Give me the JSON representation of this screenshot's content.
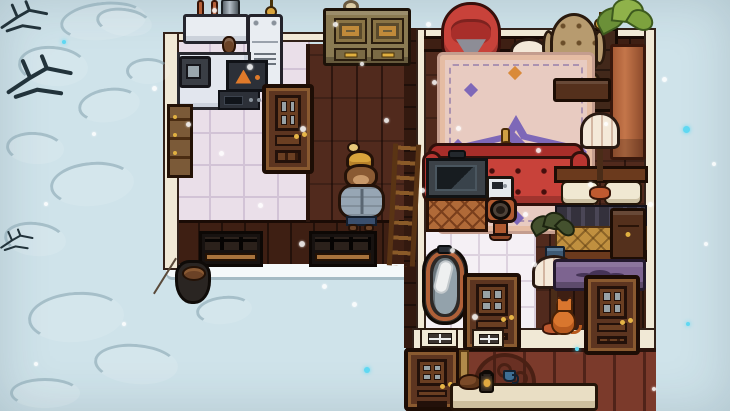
{
  "scene": {
    "description": "Top-down cozy game scene: snowy exterior around a cabin interior with kitchen, living room, bathroom and bedroom; a bear character in a beanie and puffer jacket stands in the living room while snow falls.",
    "palette": {
      "snow_ground": "#cfe3ea",
      "drift_outline": "#809eac",
      "twig": "#22333b",
      "wall_cream": "#f1e9d6",
      "wall_dark_wood": "#3e1f13",
      "wall_exterior_red": "#7b3a2b",
      "floor_planks": "#512a1d",
      "kitchen_tile": "#eadfe9",
      "bathroom_tile": "#f5f0f5",
      "rug_pink": "#e8cbc1",
      "rug_purple": "#7e68b8",
      "rug_orange": "#d98a3a",
      "sofa_red": "#c8423a",
      "chair_tan": "#b79b6f",
      "wood_furniture": "#6b3a1d",
      "olive_cabinet": "#8a7a52",
      "copper": "#b06038",
      "appliance_white": "#e9edf2",
      "metal_slate": "#93a2ab",
      "chest_purple": "#7d6490",
      "lamp_cream": "#f4e9d9",
      "plant_green": "#7da23e",
      "terracotta": "#c4764a",
      "bear_fur": "#8a5a33",
      "bear_hat_gold": "#d9a43c",
      "bear_jacket": "#97a6b4",
      "bear_pants": "#3a4f6e",
      "snowflake_white": "#ffffff",
      "snowflake_cyan": "#5fd8f2"
    },
    "regions": [
      {
        "name": "kitchen-floor",
        "kind": "floor-tiles-lav",
        "x": 177,
        "y": 38,
        "w": 133,
        "h": 190,
        "i": false
      },
      {
        "name": "living-room-floor",
        "kind": "floor-planks",
        "x": 308,
        "y": 44,
        "w": 104,
        "h": 182,
        "i": false
      },
      {
        "name": "bedroom-floor",
        "kind": "floor-planks",
        "x": 426,
        "y": 44,
        "w": 220,
        "h": 288,
        "i": false
      },
      {
        "name": "bathroom-floor",
        "kind": "floor-tiles-white",
        "x": 424,
        "y": 186,
        "w": 112,
        "h": 146,
        "i": false
      },
      {
        "name": "living-room-south-wall",
        "kind": "wall-face-dark",
        "x": 177,
        "y": 220,
        "w": 235,
        "h": 48,
        "i": false
      },
      {
        "name": "snow-ledge",
        "kind": "snow-band",
        "x": 166,
        "y": 264,
        "w": 258,
        "h": 13,
        "i": false
      },
      {
        "name": "divider-wall",
        "kind": "seam-wall",
        "x": 404,
        "y": 28,
        "w": 14,
        "h": 320,
        "i": false
      },
      {
        "name": "divider-wall-edge",
        "kind": "wall-strip-cream",
        "x": 416,
        "y": 28,
        "w": 10,
        "h": 320,
        "i": false
      },
      {
        "name": "bedroom-north-edge",
        "kind": "wall-band-cream",
        "x": 424,
        "y": 28,
        "w": 222,
        "h": 10,
        "i": false
      },
      {
        "name": "bedroom-north-wall",
        "kind": "wall-face-dark",
        "x": 424,
        "y": 36,
        "w": 222,
        "h": 16,
        "i": false
      },
      {
        "name": "kitchen-north-edge",
        "kind": "wall-band-cream",
        "x": 177,
        "y": 32,
        "w": 231,
        "h": 10,
        "i": false
      },
      {
        "name": "left-wall-edge",
        "kind": "wall-strip-cream",
        "x": 163,
        "y": 32,
        "w": 16,
        "h": 238,
        "i": false
      },
      {
        "name": "right-wall-edge",
        "kind": "wall-strip-cream",
        "x": 644,
        "y": 28,
        "w": 12,
        "h": 324,
        "i": false
      },
      {
        "name": "bedroom-under-bed-wall",
        "kind": "wall-face-dark",
        "x": 552,
        "y": 284,
        "w": 94,
        "h": 52,
        "i": false
      },
      {
        "name": "south-wall-top-band",
        "kind": "wall-band-cream",
        "x": 412,
        "y": 328,
        "w": 244,
        "h": 22,
        "i": false
      },
      {
        "name": "south-wall-exterior-face",
        "kind": "wall-face-red",
        "x": 406,
        "y": 348,
        "w": 250,
        "h": 63,
        "i": false
      },
      {
        "name": "kitchen-living-seam",
        "kind": "seam",
        "x": 306,
        "y": 44,
        "w": 4,
        "h": 178,
        "i": false
      }
    ],
    "drifts": [
      {
        "name": "snow-drift",
        "kind": "drift",
        "x": 60,
        "y": 2,
        "w": 86,
        "h": 38,
        "r": -6,
        "i": false
      },
      {
        "name": "snow-drift",
        "kind": "drift",
        "x": 18,
        "y": 46,
        "w": 70,
        "h": 40,
        "r": 5,
        "i": false
      },
      {
        "name": "snow-drift",
        "kind": "drift",
        "x": 78,
        "y": 88,
        "w": 62,
        "h": 34,
        "r": -8,
        "i": false
      },
      {
        "name": "snow-drift",
        "kind": "drift",
        "x": 6,
        "y": 132,
        "w": 58,
        "h": 32,
        "r": 4,
        "i": false
      },
      {
        "name": "snow-drift",
        "kind": "drift",
        "x": 50,
        "y": 162,
        "w": 84,
        "h": 44,
        "r": -5,
        "i": false
      },
      {
        "name": "snow-drift",
        "kind": "drift",
        "x": 4,
        "y": 222,
        "w": 62,
        "h": 34,
        "r": 6,
        "i": false
      },
      {
        "name": "snow-drift",
        "kind": "drift",
        "x": 28,
        "y": 292,
        "w": 96,
        "h": 50,
        "r": -4,
        "i": false
      },
      {
        "name": "snow-drift",
        "kind": "drift",
        "x": 94,
        "y": 344,
        "w": 84,
        "h": 40,
        "r": 5,
        "i": false
      },
      {
        "name": "snow-drift",
        "kind": "drift",
        "x": 126,
        "y": 58,
        "w": 44,
        "h": 26,
        "r": 0,
        "i": false
      },
      {
        "name": "snow-drift",
        "kind": "drift",
        "x": 96,
        "y": 8,
        "w": 56,
        "h": 28,
        "r": 8,
        "i": false
      },
      {
        "name": "snow-drift",
        "kind": "drift",
        "x": 196,
        "y": 296,
        "w": 56,
        "h": 28,
        "r": -6,
        "i": false
      },
      {
        "name": "snow-drift",
        "kind": "drift",
        "x": 10,
        "y": 378,
        "w": 70,
        "h": 30,
        "r": 0,
        "i": false
      }
    ],
    "twigs": [
      {
        "name": "bare-branch",
        "kind": "twig",
        "x": 0,
        "y": 0,
        "w": 52,
        "h": 36,
        "i": false
      },
      {
        "name": "bare-branch",
        "kind": "twig",
        "x": 6,
        "y": 54,
        "w": 72,
        "h": 50,
        "i": false
      },
      {
        "name": "bare-branch",
        "kind": "twig",
        "x": 0,
        "y": 226,
        "w": 36,
        "h": 30,
        "i": false
      }
    ],
    "items": [
      {
        "name": "wall-knob-light",
        "kind": "knob-bulb",
        "x": 343,
        "y": 0,
        "w": 16,
        "h": 13,
        "i": true
      },
      {
        "name": "kitchen-wall-lamp",
        "kind": "wall-lamp",
        "x": 263,
        "y": 0,
        "w": 18,
        "h": 18,
        "i": true
      },
      {
        "name": "stove",
        "kind": "stove",
        "x": 183,
        "y": 0,
        "w": 66,
        "h": 56,
        "i": true
      },
      {
        "name": "fridge",
        "kind": "fridge",
        "x": 247,
        "y": 14,
        "w": 36,
        "h": 76,
        "i": true
      },
      {
        "name": "armoire-cabinet",
        "kind": "armoire",
        "x": 323,
        "y": 8,
        "w": 88,
        "h": 58,
        "i": true
      },
      {
        "name": "kitchen-counter",
        "kind": "counter",
        "x": 177,
        "y": 52,
        "w": 74,
        "h": 58,
        "i": true
      },
      {
        "name": "microwave-large",
        "kind": "micro-dark",
        "x": 179,
        "y": 56,
        "w": 32,
        "h": 32,
        "i": true
      },
      {
        "name": "oven-warning-panel",
        "kind": "oven-warning",
        "x": 226,
        "y": 60,
        "w": 42,
        "h": 32,
        "i": true
      },
      {
        "name": "microwave-small",
        "kind": "micro-small",
        "x": 218,
        "y": 90,
        "w": 42,
        "h": 20,
        "i": true
      },
      {
        "name": "tall-cabinet",
        "kind": "cabinet-tall",
        "x": 167,
        "y": 104,
        "w": 26,
        "h": 74,
        "i": true
      },
      {
        "name": "kitchen-door",
        "kind": "door",
        "x": 262,
        "y": 84,
        "w": 52,
        "h": 90,
        "i": true
      },
      {
        "name": "red-armchair",
        "kind": "armchair-red",
        "x": 441,
        "y": 2,
        "w": 60,
        "h": 62,
        "i": true
      },
      {
        "name": "dark-cabinet",
        "kind": "cabinet-dark",
        "x": 584,
        "y": 28,
        "w": 34,
        "h": 84,
        "i": true
      },
      {
        "name": "bedroom-wall-lamp",
        "kind": "wall-lamp",
        "x": 592,
        "y": 12,
        "w": 20,
        "h": 30,
        "i": true
      },
      {
        "name": "side-table-lamp",
        "kind": "lamp-table",
        "x": 503,
        "y": 38,
        "w": 52,
        "h": 68,
        "i": true
      },
      {
        "name": "wingback-chair",
        "kind": "wingback",
        "x": 544,
        "y": 13,
        "w": 60,
        "h": 84,
        "i": true
      },
      {
        "name": "tall-planter",
        "kind": "planter",
        "x": 598,
        "y": 0,
        "w": 54,
        "h": 162,
        "i": true
      },
      {
        "name": "area-rug",
        "kind": "rug",
        "x": 437,
        "y": 52,
        "w": 158,
        "h": 182,
        "i": true
      },
      {
        "name": "dark-side-table",
        "kind": "dark-table",
        "x": 553,
        "y": 78,
        "w": 58,
        "h": 24,
        "i": true
      },
      {
        "name": "gold-vase",
        "kind": "gold-vase",
        "x": 494,
        "y": 128,
        "w": 24,
        "h": 48,
        "i": true
      },
      {
        "name": "red-couch",
        "kind": "couch",
        "x": 422,
        "y": 143,
        "w": 168,
        "h": 66,
        "i": true
      },
      {
        "name": "bed",
        "kind": "bed",
        "x": 554,
        "y": 166,
        "w": 94,
        "h": 98,
        "i": true
      },
      {
        "name": "bedroom-floor-lamp",
        "kind": "lamp",
        "x": 580,
        "y": 112,
        "w": 40,
        "h": 88,
        "i": true
      },
      {
        "name": "nightstand",
        "kind": "nightstand",
        "x": 610,
        "y": 208,
        "w": 36,
        "h": 52,
        "i": true
      },
      {
        "name": "sink-vanity",
        "kind": "sink-vanity",
        "x": 426,
        "y": 152,
        "w": 62,
        "h": 80,
        "i": true
      },
      {
        "name": "white-appliance",
        "kind": "appliance",
        "x": 486,
        "y": 176,
        "w": 28,
        "h": 34,
        "i": true
      },
      {
        "name": "toilet",
        "kind": "toilet",
        "x": 485,
        "y": 197,
        "w": 32,
        "h": 46,
        "i": true
      },
      {
        "name": "dark-potted-plant",
        "kind": "plant-dark",
        "x": 530,
        "y": 214,
        "w": 48,
        "h": 52,
        "i": true
      },
      {
        "name": "ladder",
        "kind": "ladder",
        "x": 390,
        "y": 144,
        "w": 28,
        "h": 122,
        "r": 3,
        "i": true
      },
      {
        "name": "bear-character",
        "kind": "bear",
        "x": 338,
        "y": 146,
        "w": 48,
        "h": 88,
        "i": true
      },
      {
        "name": "barred-window-left",
        "kind": "barred-window",
        "x": 199,
        "y": 231,
        "w": 64,
        "h": 36,
        "i": true
      },
      {
        "name": "barred-window-right",
        "kind": "barred-window",
        "x": 309,
        "y": 231,
        "w": 68,
        "h": 36,
        "i": true
      },
      {
        "name": "cooking-pot",
        "kind": "pot",
        "x": 175,
        "y": 260,
        "w": 36,
        "h": 44,
        "i": true
      },
      {
        "name": "bathtub",
        "kind": "bathtub",
        "x": 422,
        "y": 247,
        "w": 46,
        "h": 78,
        "i": true
      },
      {
        "name": "bathroom-floor-lamp",
        "kind": "lamp",
        "x": 532,
        "y": 255,
        "w": 44,
        "h": 80,
        "i": true
      },
      {
        "name": "orange-cat",
        "kind": "cat",
        "x": 549,
        "y": 297,
        "w": 30,
        "h": 40,
        "i": true
      },
      {
        "name": "purple-chest",
        "kind": "chest-purple",
        "x": 553,
        "y": 259,
        "w": 93,
        "h": 32,
        "i": true
      },
      {
        "name": "bedroom-south-door",
        "kind": "door",
        "x": 584,
        "y": 275,
        "w": 56,
        "h": 80,
        "i": true
      },
      {
        "name": "bathroom-south-door",
        "kind": "door",
        "x": 463,
        "y": 273,
        "w": 58,
        "h": 78,
        "i": true
      },
      {
        "name": "small-window-1",
        "kind": "window-small",
        "x": 420,
        "y": 328,
        "w": 38,
        "h": 20,
        "i": true
      },
      {
        "name": "small-window-2",
        "kind": "window-small",
        "x": 472,
        "y": 329,
        "w": 32,
        "h": 19,
        "i": true
      },
      {
        "name": "bottom-door",
        "kind": "door",
        "x": 404,
        "y": 348,
        "w": 56,
        "h": 63,
        "i": true
      },
      {
        "name": "broom-pole",
        "kind": "pole",
        "x": 459,
        "y": 350,
        "w": 10,
        "h": 61,
        "i": true
      },
      {
        "name": "iron-headboard",
        "kind": "iron-decor",
        "x": 474,
        "y": 353,
        "w": 62,
        "h": 47,
        "i": true
      },
      {
        "name": "cream-table",
        "kind": "cream-table",
        "x": 450,
        "y": 383,
        "w": 148,
        "h": 28,
        "i": true
      },
      {
        "name": "table-critter",
        "kind": "critter",
        "x": 458,
        "y": 374,
        "w": 24,
        "h": 16,
        "i": true
      },
      {
        "name": "table-lantern",
        "kind": "lantern",
        "x": 479,
        "y": 372,
        "w": 15,
        "h": 21,
        "i": true
      },
      {
        "name": "blue-cup",
        "kind": "cup",
        "x": 503,
        "y": 370,
        "w": 13,
        "h": 12,
        "i": true
      }
    ],
    "snowflakes": [
      [
        212,
        8,
        5,
        "w"
      ],
      [
        247,
        64,
        6,
        "w"
      ],
      [
        333,
        22,
        5,
        "w"
      ],
      [
        300,
        126,
        6,
        "w"
      ],
      [
        219,
        151,
        5,
        "w"
      ],
      [
        258,
        203,
        5,
        "w"
      ],
      [
        299,
        241,
        6,
        "w"
      ],
      [
        322,
        284,
        5,
        "w"
      ],
      [
        352,
        302,
        5,
        "w"
      ],
      [
        364,
        367,
        6,
        "c"
      ],
      [
        426,
        22,
        5,
        "w"
      ],
      [
        432,
        80,
        5,
        "w"
      ],
      [
        456,
        126,
        5,
        "w"
      ],
      [
        523,
        212,
        5,
        "w"
      ],
      [
        532,
        262,
        5,
        "w"
      ],
      [
        472,
        314,
        6,
        "w"
      ],
      [
        588,
        182,
        5,
        "w"
      ],
      [
        604,
        122,
        4,
        "w"
      ],
      [
        648,
        202,
        5,
        "w"
      ],
      [
        662,
        77,
        5,
        "w"
      ],
      [
        683,
        126,
        7,
        "c"
      ],
      [
        704,
        242,
        4,
        "w"
      ],
      [
        152,
        86,
        5,
        "w"
      ],
      [
        92,
        132,
        4,
        "w"
      ],
      [
        44,
        202,
        4,
        "w"
      ],
      [
        122,
        322,
        4,
        "w"
      ],
      [
        34,
        362,
        4,
        "w"
      ],
      [
        686,
        322,
        4,
        "c"
      ],
      [
        712,
        162,
        4,
        "w"
      ],
      [
        652,
        387,
        4,
        "w"
      ],
      [
        62,
        40,
        4,
        "c"
      ],
      [
        186,
        122,
        5,
        "w"
      ],
      [
        420,
        188,
        5,
        "w"
      ],
      [
        575,
        347,
        4,
        "c"
      ],
      [
        450,
        248,
        5,
        "w"
      ],
      [
        384,
        118,
        5,
        "w"
      ],
      [
        360,
        62,
        4,
        "w"
      ],
      [
        536,
        148,
        5,
        "w"
      ]
    ]
  }
}
